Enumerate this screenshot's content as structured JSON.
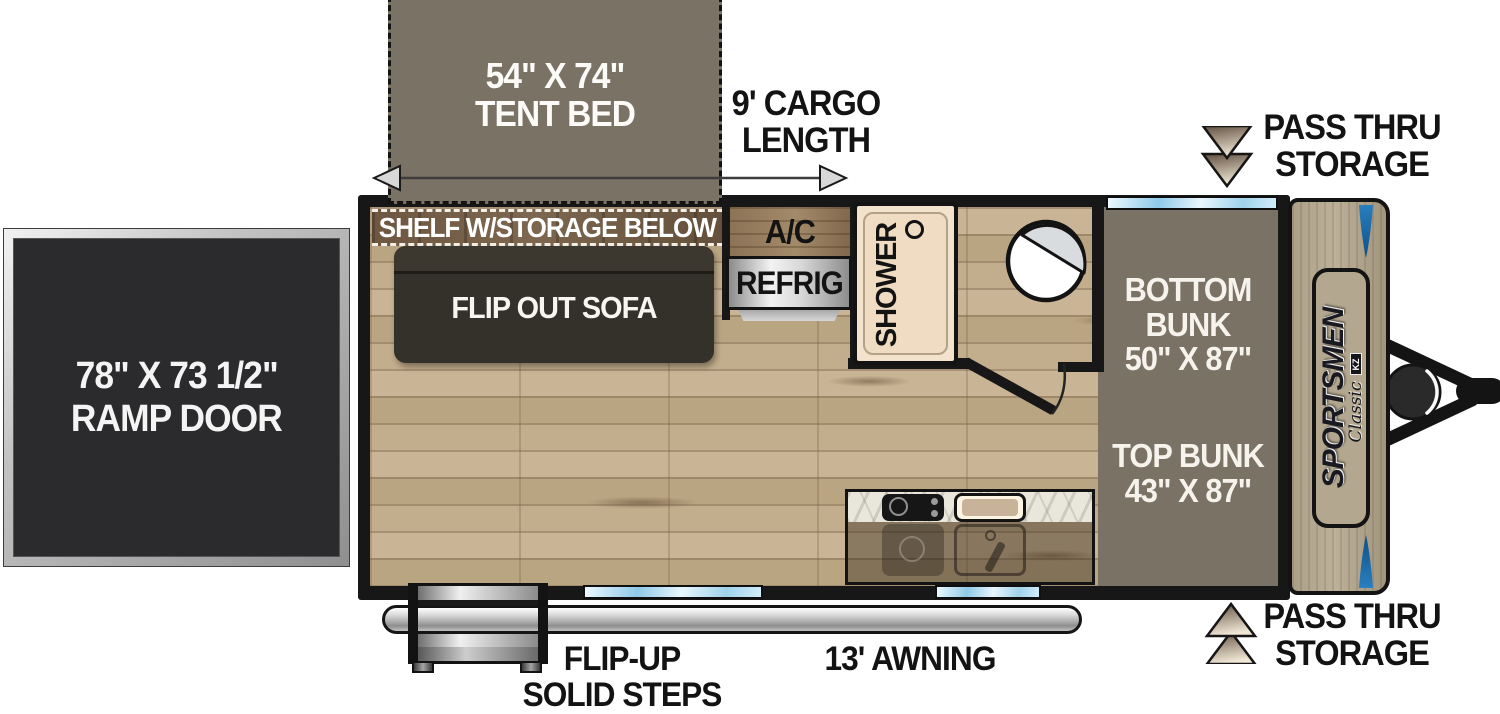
{
  "floorplan": {
    "tent_bed": {
      "size": "54\" X 74\"",
      "label": "TENT BED"
    },
    "cargo": {
      "line1": "9' CARGO",
      "line2": "LENGTH"
    },
    "pass_thru_top": {
      "line1": "PASS THRU",
      "line2": "STORAGE"
    },
    "pass_thru_bottom": {
      "line1": "PASS THRU",
      "line2": "STORAGE"
    },
    "ramp_door": {
      "size": "78\" X 73 1/2\"",
      "label": "RAMP DOOR"
    },
    "shelf": {
      "label": "SHELF W/STORAGE BELOW"
    },
    "sofa": {
      "label": "FLIP OUT SOFA"
    },
    "ac": {
      "label": "A/C"
    },
    "refrig": {
      "label": "REFRIG"
    },
    "shower": {
      "label": "SHOWER"
    },
    "bunks": {
      "bottom_line1": "BOTTOM",
      "bottom_line2": "BUNK",
      "bottom_size": "50\" X 87\"",
      "top_line1": "TOP BUNK",
      "top_size": "43\" X 87\""
    },
    "steps": {
      "line1": "FLIP-UP",
      "line2": "SOLID STEPS"
    },
    "awning": {
      "label": "13' AWNING"
    },
    "brand": {
      "name": "SPORTSMEN",
      "series": "Classic",
      "maker": "KZ"
    }
  },
  "colors": {
    "wall_black": "#171717",
    "floor_wood": "#c3ae8d",
    "bed_taupe": "#7a7265",
    "shelf_wood": "#6d5741",
    "sofa_dark": "#34302a",
    "ramp_door_dark": "#2b2b2d",
    "shower_cream": "#f3e3cd",
    "window_blue": "#9fd2ec",
    "panel_tan": "#b3a78f",
    "accent_blue": "#1b6cae",
    "arrow_gradient_dark": "#5f4d3c",
    "arrow_gradient_light": "#f1e7d6"
  }
}
